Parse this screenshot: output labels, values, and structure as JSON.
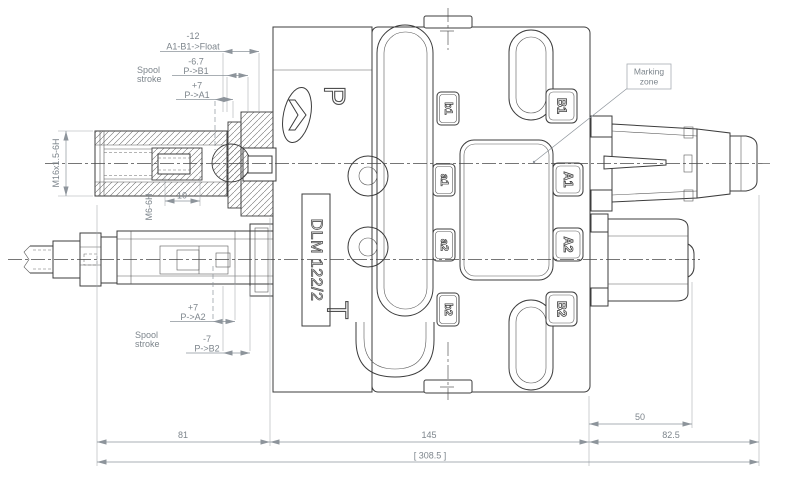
{
  "drawing": {
    "model_label": "DLM 122/2",
    "port_p": "P",
    "port_t": "T",
    "marking_zone": {
      "line1": "Marking",
      "line2": "zone"
    },
    "ports_left": [
      "b1",
      "a1",
      "a2",
      "b2"
    ],
    "ports_right": [
      "B1",
      "A1",
      "A2",
      "B2"
    ],
    "threads": {
      "outer_thread": "M16x1.5-6H",
      "inner_thread": "M6-6H",
      "thread_depth": "10"
    },
    "spool_stroke_top": {
      "title1": "Spool",
      "title2": "stroke",
      "float_value": "-12",
      "float_label": "A1-B1->Float",
      "pb1_value": "-6.7",
      "pb1_label": "P->B1",
      "pa1_value": "+7",
      "pa1_label": "P->A1"
    },
    "spool_stroke_bottom": {
      "title1": "Spool",
      "title2": "stroke",
      "pa2_value": "+7",
      "pa2_label": "P->A2",
      "pb2_value": "-7",
      "pb2_label": "P->B2"
    },
    "dimensions": {
      "left_span": "81",
      "body_span": "145",
      "right_span": "82.5",
      "cap_span": "50",
      "overall_span": "[ 308.5 ]"
    }
  }
}
